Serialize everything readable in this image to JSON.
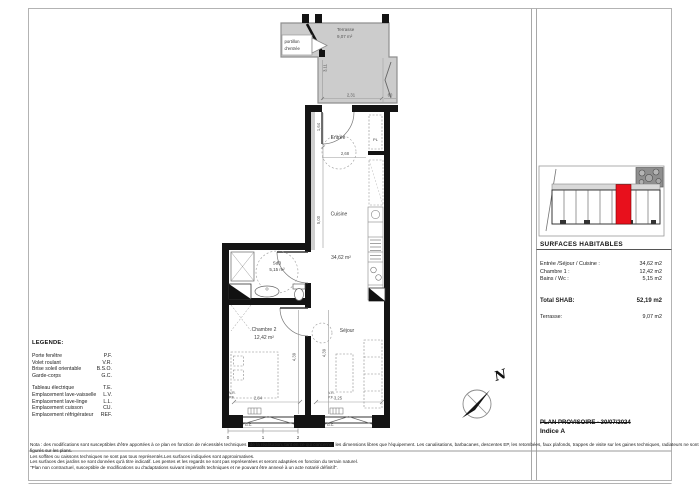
{
  "plan": {
    "terrace": {
      "name": "Terrasse",
      "area": "9,07 m²"
    },
    "gate": {
      "line1": "portillon",
      "line2": "d'entrée"
    },
    "rooms": {
      "entree": "Entrée",
      "cuisine": "Cuisine",
      "cuisine_area": "34,62 m²",
      "sdb": "SdB",
      "sdb_area": "5,15 m²",
      "chambre": "Chambre 2",
      "chambre_area": "12,42 m²",
      "sejour": "Séjour",
      "placard": "PL"
    },
    "dims": {
      "terrace_height": "3,11",
      "terrace_width": "2,31",
      "terrace_door": "60",
      "entree_height": "1,64",
      "entree_width": "2,68",
      "cuisine_height": "5,00",
      "chambre_height": "4,39",
      "sejour_height": "4,39",
      "chambre_width": "2,84",
      "sejour_width": "3,25"
    },
    "windows": {
      "pf": "P.F.",
      "vr": "V.R.",
      "gc": "G.C."
    },
    "scale_ticks": [
      "0",
      "1",
      "2"
    ],
    "north_label": "N"
  },
  "legend": {
    "title": "LEGENDE:",
    "items": [
      {
        "label": "Porte fenêtre",
        "abbr": "P.F."
      },
      {
        "label": "Volet roulant",
        "abbr": "V.R."
      },
      {
        "label": "Brise soleil orientable",
        "abbr": "B.S.O."
      },
      {
        "label": "Garde-corps",
        "abbr": "G.C."
      },
      {
        "label": "Tableau électrique",
        "abbr": "T.E."
      },
      {
        "label": "Emplacement lave-vaisselle",
        "abbr": "L.V."
      },
      {
        "label": "Emplacement lave-linge",
        "abbr": "L.L."
      },
      {
        "label": "Emplacement cuisson",
        "abbr": "CU."
      },
      {
        "label": "Emplacement réfrigérateur",
        "abbr": "REF."
      }
    ]
  },
  "surfaces": {
    "title": "SURFACES HABITABLES",
    "rows": [
      {
        "label": "Entrée /Séjour / Cuisine :",
        "value": "34,62 m2"
      },
      {
        "label": "Chambre 1 :",
        "value": "12,42 m2"
      },
      {
        "label": "Bains / Wc :",
        "value": "5,15 m2"
      }
    ],
    "total_label": "Total SHAB:",
    "total_value": "52,19 m2",
    "terrace_label": "Terrasse:",
    "terrace_value": "9,07 m2"
  },
  "titleblock": {
    "status": "PLAN PROVISOIRE - 30/07/2024",
    "index": "Indice A"
  },
  "notes": {
    "line1_start": "Nota : des modifications sont susceptibles d'être apportées à ce plan en fonction de nécessités techniques ",
    "line1_redacted": "de la réalisation, tant en ce qui concerne",
    "line1_end": " les dimensions libres que l'équipement. Les canalisations, barbacanes, descentes EP, les retombées, faux plafonds, trappes de visite sur les gaines techniques, radiateurs ne sont pas",
    "line2": "figurés sur les plans.",
    "line3": "Les soffites ou caissons techniques ne sont pas tous représentés.Les surfaces indiquées sont approximatives.",
    "line4": "Les surfaces des jardins ne sont données qu'à titre indicatif. Les pentes et les regards ne sont pas représentées et seront adaptées en fonction du terrain naturel.",
    "line5": "\"Plan non contractuel, susceptible de modifications ou d'adaptations suivant impératifs techniques et ne pouvant être annexé à un acte notarié définitif\"."
  },
  "colors": {
    "highlight_unit": "#e8101c",
    "terrace_fill": "#cccccc",
    "wall": "#141414"
  }
}
